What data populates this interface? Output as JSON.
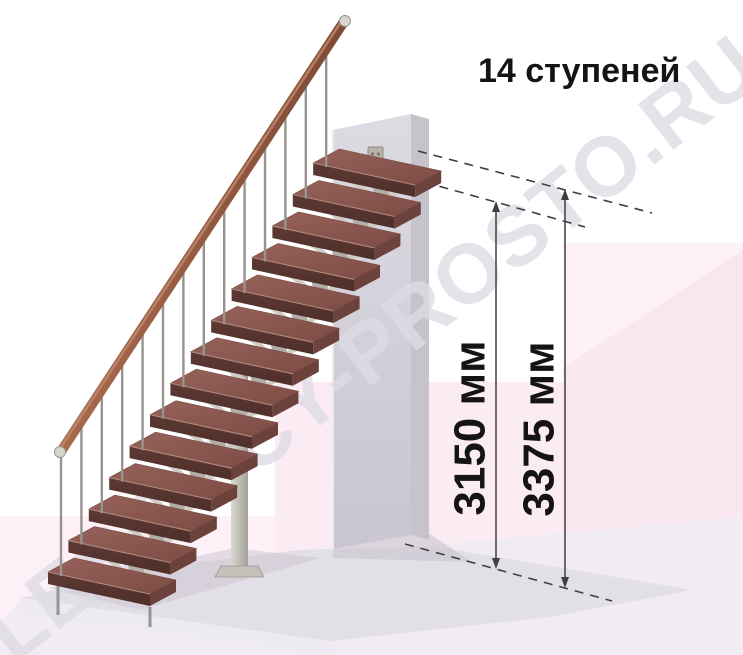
{
  "title": "14 ступеней",
  "watermark": "LESTNICY-PROSTO.RU",
  "dimensions": {
    "step_level_height": "3150 мм",
    "floor_level_height": "3375 мм"
  },
  "stairs": {
    "step_count": 14
  },
  "colors": {
    "bg-pink-light": "#fdf1f7",
    "bg-pink-mid": "#fbebf3",
    "bg-pink-dark": "#f9e7f0",
    "floor-open": "#f1ecf3",
    "floor-slab": "#e2dfe7",
    "floor-slab-front": "#edebf1",
    "shadow": "#c9c4cf",
    "wall-top": "#dddbe2",
    "wall-bottom": "#c9c5d1",
    "wall-side": "#c6c3cd",
    "wall-highlight": "#eceaf0",
    "tread-top-a": "#96625a",
    "tread-top-b": "#7e4c45",
    "tread-front": "#5d3934",
    "tread-side": "#6b423c",
    "tread-edge": "#b18a7c",
    "rail": "#9e6049",
    "rail-light": "#c08a6e",
    "rail-cap": "#d8d5cf",
    "metal": "#97948f",
    "support-plate": "#b2aea7",
    "support-arm": "#d0ccc4",
    "bracket": "#b7b3ac",
    "column-a": "#dcd9d3",
    "column-b": "#a39f99",
    "line": "#3f3f3f",
    "text": "#141414",
    "watermark-color": "rgba(222,219,227,0.8)"
  }
}
